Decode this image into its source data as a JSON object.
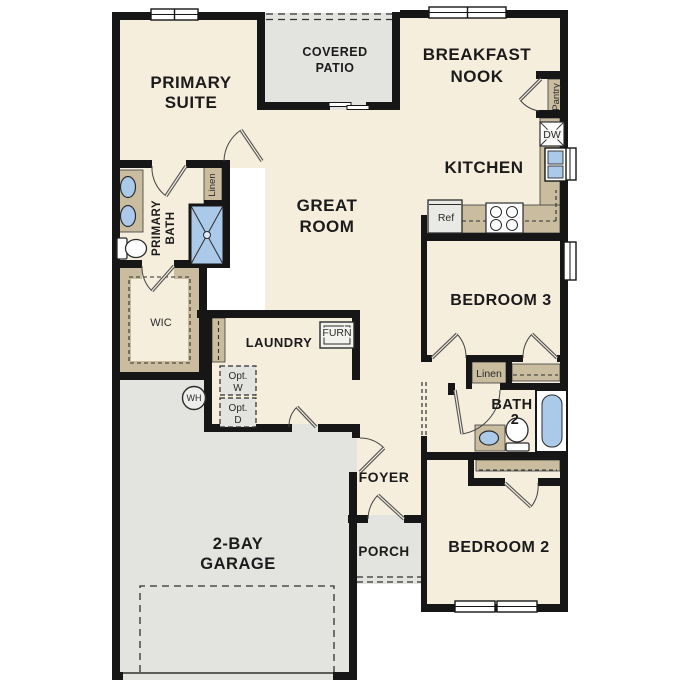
{
  "rooms": {
    "primary_suite": {
      "l1": "PRIMARY",
      "l2": "SUITE"
    },
    "covered_patio": {
      "l1": "COVERED",
      "l2": "PATIO"
    },
    "breakfast_nook": {
      "l1": "BREAKFAST",
      "l2": "NOOK"
    },
    "kitchen": {
      "label": "KITCHEN"
    },
    "great_room": {
      "l1": "GREAT",
      "l2": "ROOM"
    },
    "primary_bath": {
      "l1": "PRIMARY",
      "l2": "BATH"
    },
    "wic": {
      "label": "WIC"
    },
    "laundry": {
      "label": "LAUNDRY"
    },
    "bedroom3": {
      "label": "BEDROOM 3"
    },
    "bath2": {
      "l1": "BATH",
      "l2": "2"
    },
    "bedroom2": {
      "label": "BEDROOM 2"
    },
    "foyer": {
      "label": "FOYER"
    },
    "porch": {
      "label": "PORCH"
    },
    "garage": {
      "l1": "2-BAY",
      "l2": "GARAGE"
    }
  },
  "features": {
    "pantry": "Pantry",
    "linen_primary": "Linen",
    "linen_hall": "Linen",
    "dishwasher": "DW",
    "refrigerator": "Ref",
    "furnace": "FURN",
    "opt_washer": {
      "l1": "Opt.",
      "l2": "W"
    },
    "opt_dryer": {
      "l1": "Opt.",
      "l2": "D"
    },
    "water_heater": "WH"
  },
  "colors": {
    "floor": "#f6eedd",
    "patio_porch_garage": "#e3e3e0",
    "cabinet_tan": "#c9bc9f",
    "fixture_blue": "#abc9e9",
    "wall": "#161616"
  }
}
